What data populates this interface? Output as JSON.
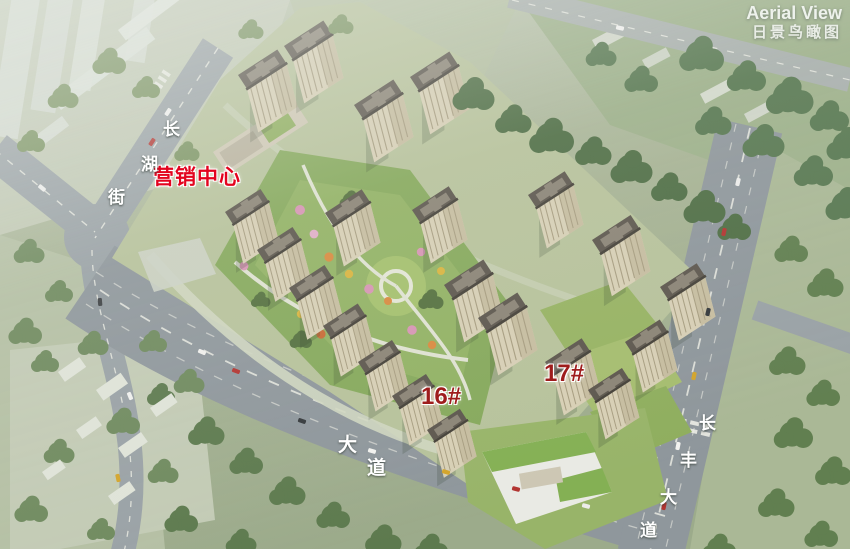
{
  "view": {
    "title_en": "Aerial View",
    "title_zh": "日景鸟瞰图"
  },
  "annotations": {
    "marketing_center": "营销中心",
    "building_16": "16#",
    "building_17": "17#"
  },
  "roads": {
    "changhu_street": {
      "name": "长湖街",
      "chars": [
        "长",
        "湖",
        "街"
      ]
    },
    "south_avenue": {
      "name": "大道",
      "chars": [
        "大",
        "道"
      ]
    },
    "changfeng_avenue": {
      "name": "长丰大道",
      "chars": [
        "长",
        "丰",
        "大",
        "道"
      ]
    }
  },
  "colors": {
    "marketing_label_red": "#e3041f",
    "building_label_red": "#9e1c1c",
    "road_label_white": "#ffffff",
    "caption_white": "#eef2ec",
    "field_green": "#a7b394",
    "road_gray": "#949ca0",
    "tower_facade": "#d7cfb5",
    "tower_roof": "#5d574e",
    "park_green": "#86a95c",
    "school_roof_green": "#84b054"
  }
}
